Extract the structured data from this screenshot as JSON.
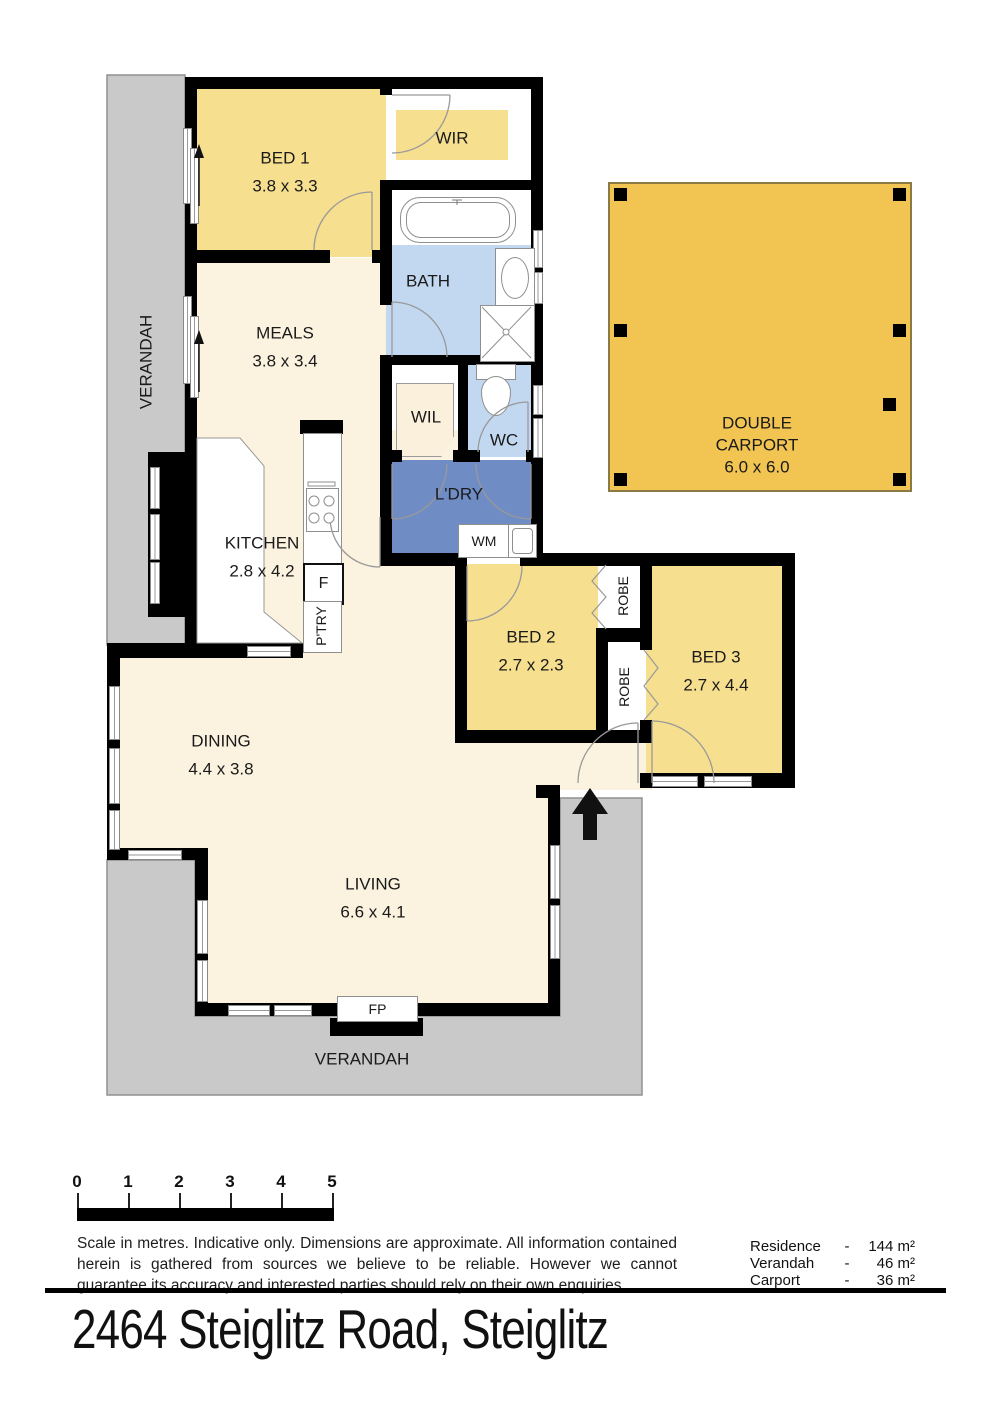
{
  "address": "2464 Steiglitz Road, Steiglitz",
  "labels": {
    "verandah_left": "VERANDAH",
    "verandah_bottom": "VERANDAH",
    "bed1": "BED 1",
    "bed1_dims": "3.8 x 3.3",
    "wir": "WIR",
    "bath": "BATH",
    "meals": "MEALS",
    "meals_dims": "3.8 x 3.4",
    "wil": "WIL",
    "wc": "WC",
    "ldry": "L'DRY",
    "wm": "WM",
    "kitchen": "KITCHEN",
    "kitchen_dims": "2.8 x 4.2",
    "fridge": "F",
    "pantry": "P'TRY",
    "bed2": "BED 2",
    "bed2_dims": "2.7 x 2.3",
    "bed3": "BED 3",
    "bed3_dims": "2.7 x 4.4",
    "robe_top": "ROBE",
    "robe_bottom": "ROBE",
    "dining": "DINING",
    "dining_dims": "4.4 x 3.8",
    "living": "LIVING",
    "living_dims": "6.6 x 4.1",
    "fireplace": "FP",
    "carport_line1": "DOUBLE",
    "carport_line2": "CARPORT",
    "carport_dims": "6.0 x 6.0"
  },
  "scale": {
    "ticks": [
      "0",
      "1",
      "2",
      "3",
      "4",
      "5"
    ]
  },
  "disclaimer": "Scale in metres. Indicative only. Dimensions are approximate.  All information contained herein is gathered from sources we believe to be reliable. However we cannot guarantee its accuracy and interested parties should rely on their own enquiries.",
  "areas": [
    {
      "name": "Residence",
      "dash": "-",
      "value": "144 m²"
    },
    {
      "name": "Verandah",
      "dash": "-",
      "value": "46 m²"
    },
    {
      "name": "Carport",
      "dash": "-",
      "value": "36 m²"
    }
  ],
  "colors": {
    "bedroom_fill": "#F6DF8F",
    "living_fill": "#FBF3DF",
    "bath_fill": "#C2D8F0",
    "laundry_fill": "#6F8CC5",
    "carport_fill": "#F2C452",
    "verandah_fill": "#C9C9C9",
    "wall": "#000000"
  }
}
